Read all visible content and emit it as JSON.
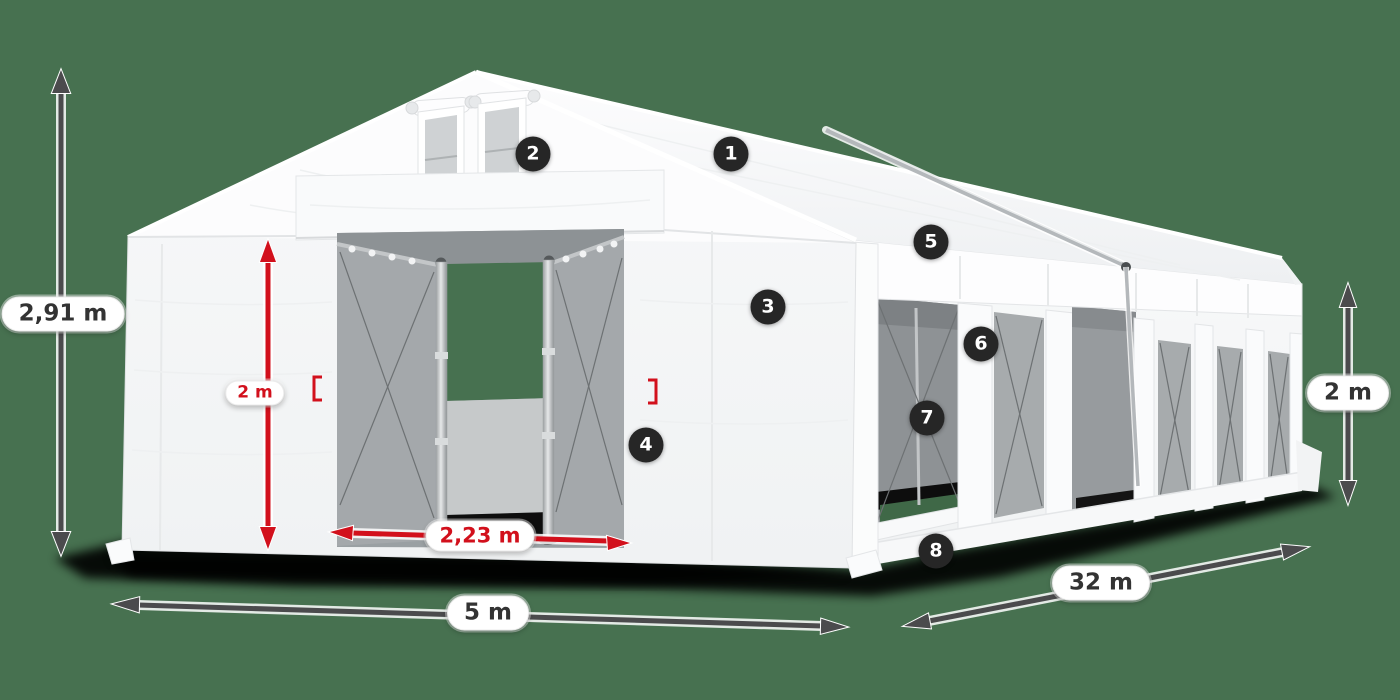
{
  "colors": {
    "bg": "#477150",
    "red": "#d2101c",
    "dim": "#4b4b4d",
    "badge": "#262626",
    "pill-bg": "#ffffff",
    "pill-text": "#333333"
  },
  "badges": [
    "1",
    "2",
    "3",
    "4",
    "5",
    "6",
    "7",
    "8"
  ],
  "dimensions": {
    "total_height": {
      "text": "2,91 m"
    },
    "door_height": {
      "text": "2 m"
    },
    "door_width": {
      "text": "2,23 m"
    },
    "front_width": {
      "text": "5 m"
    },
    "length": {
      "text": "32 m"
    },
    "side_height": {
      "text": "2 m"
    }
  }
}
